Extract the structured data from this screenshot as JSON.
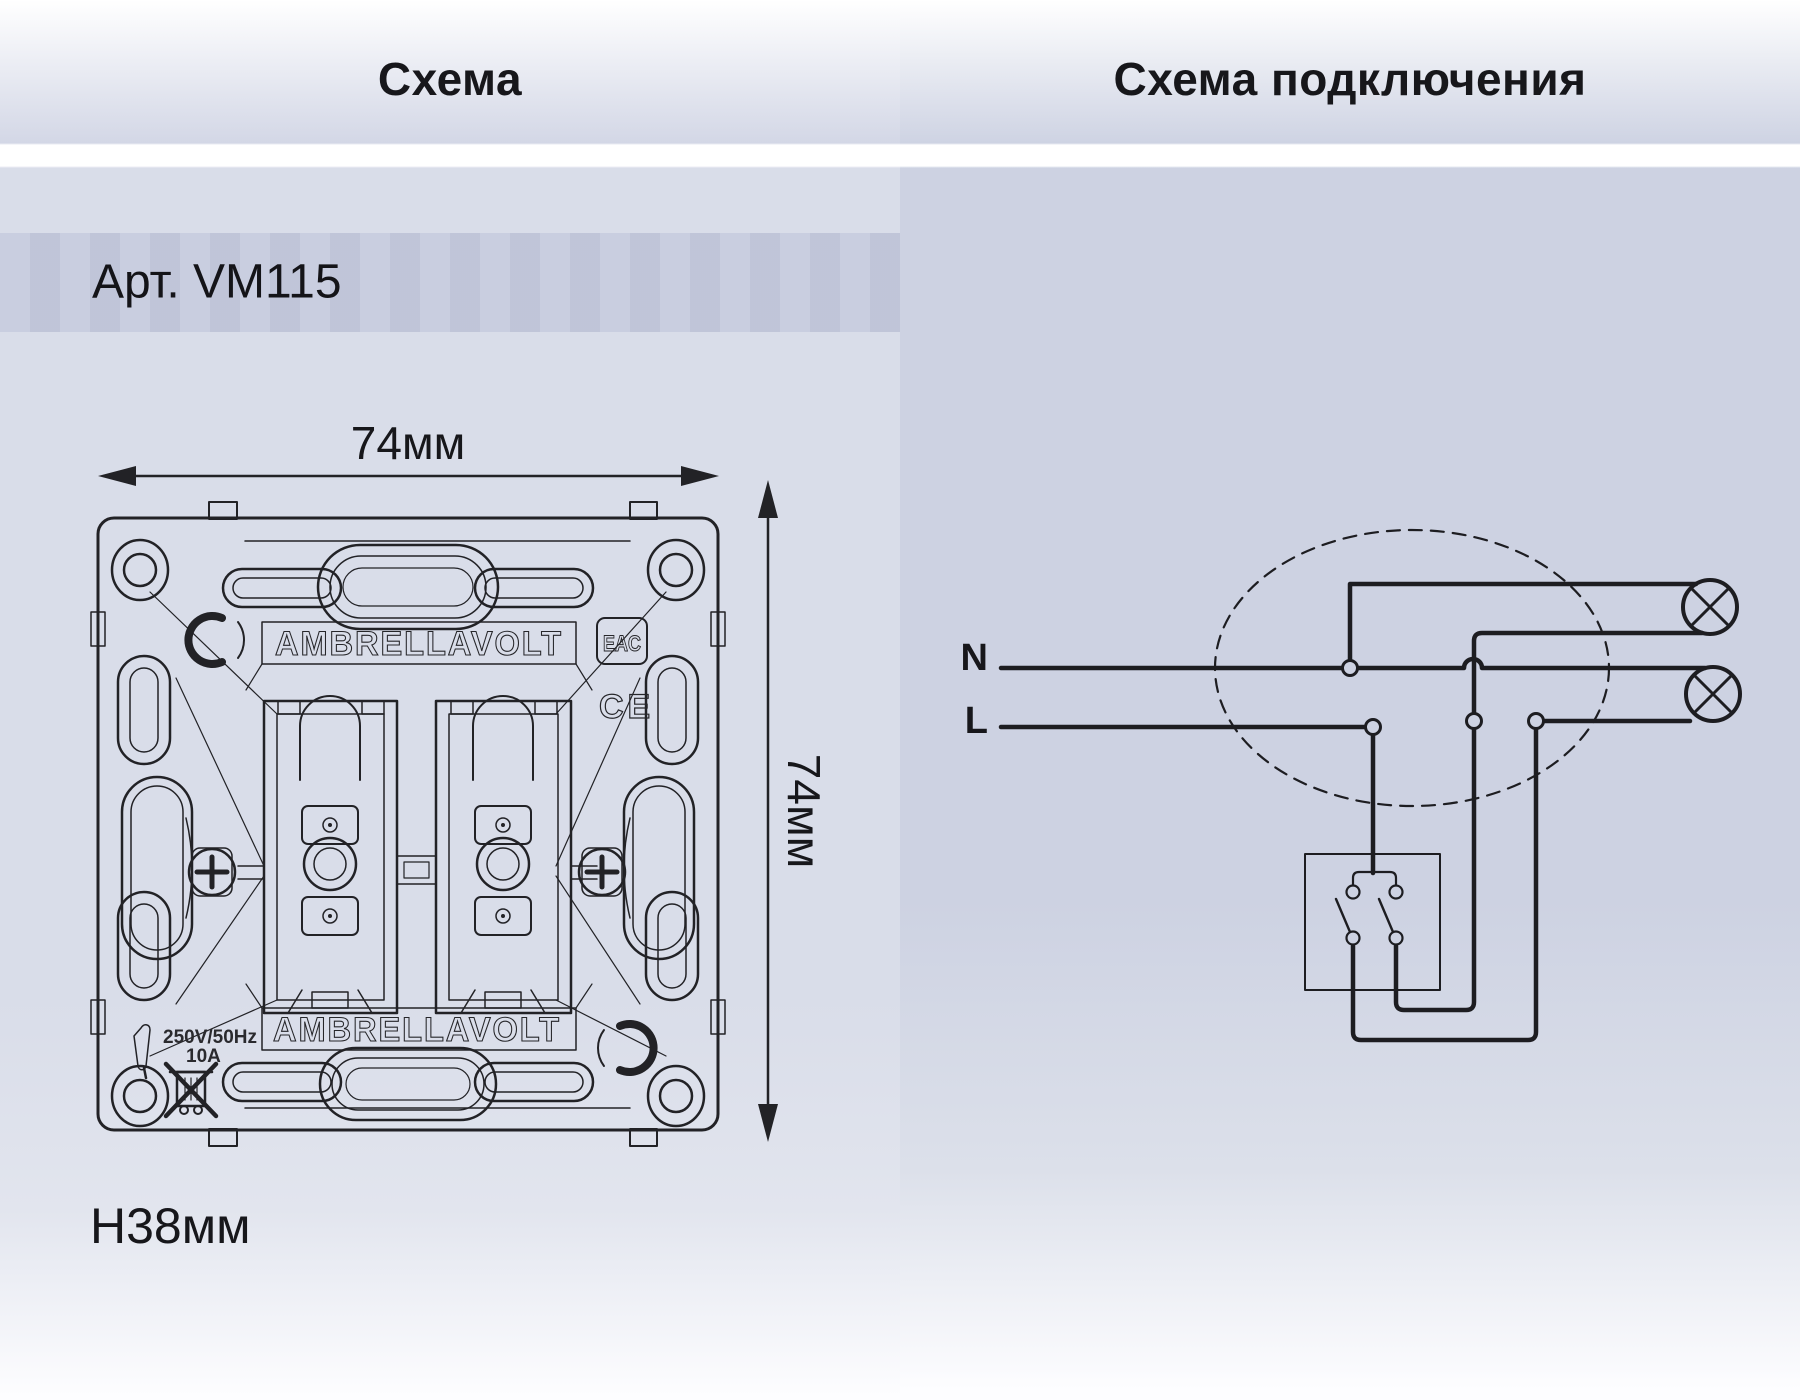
{
  "header": {
    "left_title": "Схема",
    "right_title": "Схема подключения"
  },
  "left_panel": {
    "article": "Арт. VM115",
    "width_label": "74мм",
    "height_label": "74мм",
    "depth_label": "H38мм",
    "brand_top": "AMBRELLAVOLT",
    "brand_bottom": "AMBRELLAVOLT",
    "eac_mark": "EAC",
    "ce_mark": "CE",
    "rating_voltage": "250V/50Hz",
    "rating_current": "10A"
  },
  "right_panel": {
    "neutral_label": "N",
    "line_label": "L"
  },
  "colors": {
    "title_text": "#17171b",
    "band_bg": "#c6cbde",
    "left_bg": "#d9dde9",
    "right_bg": "#cdd2e2",
    "line_color": "#222226"
  }
}
